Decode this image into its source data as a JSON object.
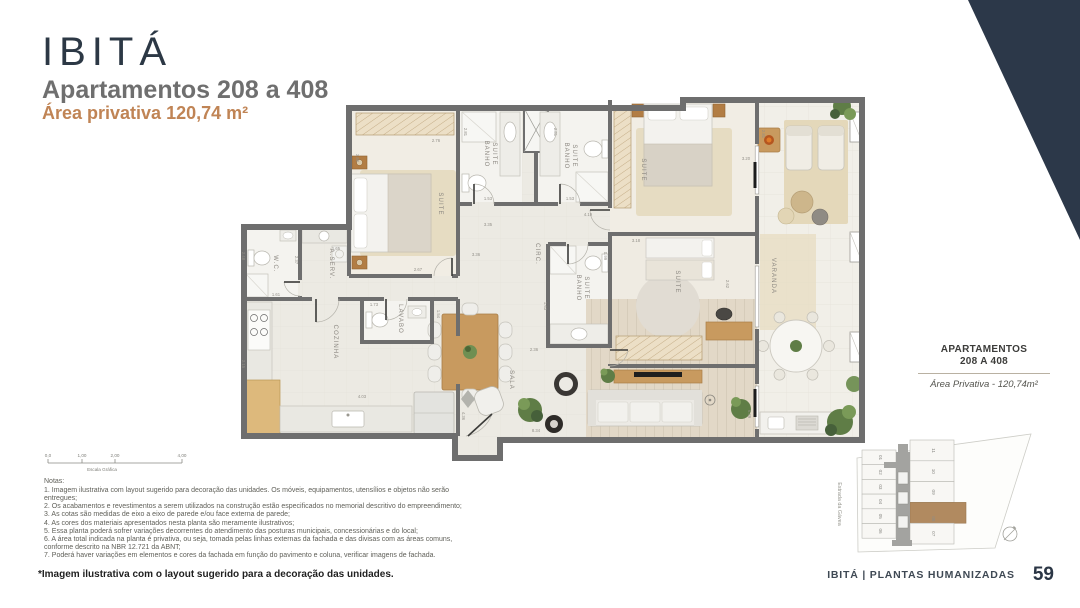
{
  "page": {
    "background": "#ffffff",
    "accent_color": "#2c3849"
  },
  "header": {
    "logo": "IBITÁ",
    "title": "Apartamentos 208 a 408",
    "subtitle": "Área privativa 120,74 m²"
  },
  "plan": {
    "room_labels": [
      {
        "t": "SUITE",
        "x": 203,
        "y": 120
      },
      {
        "t": "BANHO",
        "x": 249,
        "y": 70
      },
      {
        "t": "SUITE",
        "x": 257,
        "y": 70
      },
      {
        "t": "BANHO",
        "x": 329,
        "y": 72
      },
      {
        "t": "SUITE",
        "x": 337,
        "y": 72
      },
      {
        "t": "SUITE",
        "x": 406,
        "y": 86
      },
      {
        "t": "VARANDA",
        "x": 536,
        "y": 192
      },
      {
        "t": "CIRC.",
        "x": 300,
        "y": 170
      },
      {
        "t": "BANHO",
        "x": 341,
        "y": 204
      },
      {
        "t": "SUITE",
        "x": 349,
        "y": 204
      },
      {
        "t": "SUITE",
        "x": 440,
        "y": 198
      },
      {
        "t": "W.C.",
        "x": 38,
        "y": 180
      },
      {
        "t": "A.SERV.",
        "x": 94,
        "y": 180
      },
      {
        "t": "LAVABO",
        "x": 163,
        "y": 235
      },
      {
        "t": "COZINHA",
        "x": 98,
        "y": 258
      },
      {
        "t": "SALA",
        "x": 274,
        "y": 296
      }
    ],
    "dim_labels": [
      {
        "t": "3.80",
        "x": 120,
        "y": 74,
        "v": 1
      },
      {
        "t": "2.76",
        "x": 200,
        "y": 58,
        "v": 0
      },
      {
        "t": "2.81",
        "x": 228,
        "y": 48,
        "v": 1
      },
      {
        "t": "2.81",
        "x": 318,
        "y": 48,
        "v": 1
      },
      {
        "t": "2.81",
        "x": 526,
        "y": 50,
        "v": 1
      },
      {
        "t": "1.53",
        "x": 252,
        "y": 116,
        "v": 0
      },
      {
        "t": "1.53",
        "x": 334,
        "y": 116,
        "v": 0
      },
      {
        "t": "4.19",
        "x": 352,
        "y": 132,
        "v": 0
      },
      {
        "t": "3.35",
        "x": 252,
        "y": 142,
        "v": 0
      },
      {
        "t": "3.36",
        "x": 240,
        "y": 172,
        "v": 0
      },
      {
        "t": "2.67",
        "x": 182,
        "y": 187,
        "v": 0
      },
      {
        "t": "3.18",
        "x": 400,
        "y": 158,
        "v": 0
      },
      {
        "t": "3.20",
        "x": 510,
        "y": 76,
        "v": 0
      },
      {
        "t": "0.99",
        "x": 368,
        "y": 172,
        "v": 1
      },
      {
        "t": "2.62",
        "x": 490,
        "y": 200,
        "v": 1
      },
      {
        "t": "6.39",
        "x": 512,
        "y": 330,
        "v": 1
      },
      {
        "t": "2.48",
        "x": 6,
        "y": 172,
        "v": 1
      },
      {
        "t": "2.37",
        "x": 59,
        "y": 176,
        "v": 1
      },
      {
        "t": "1.65",
        "x": 100,
        "y": 166,
        "v": 0
      },
      {
        "t": "1.61",
        "x": 40,
        "y": 212,
        "v": 0
      },
      {
        "t": "1.73",
        "x": 138,
        "y": 222,
        "v": 0
      },
      {
        "t": "1.54",
        "x": 201,
        "y": 230,
        "v": 1
      },
      {
        "t": "4.03",
        "x": 126,
        "y": 314,
        "v": 0
      },
      {
        "t": "2.15",
        "x": 6,
        "y": 280,
        "v": 1
      },
      {
        "t": "2.36",
        "x": 298,
        "y": 267,
        "v": 0
      },
      {
        "t": "1.63",
        "x": 308,
        "y": 222,
        "v": 1
      },
      {
        "t": "4.36",
        "x": 226,
        "y": 332,
        "v": 1
      },
      {
        "t": "8.34",
        "x": 300,
        "y": 348,
        "v": 0
      }
    ]
  },
  "scale_bar": {
    "ticks": [
      "0,0",
      "1,00",
      "2,00",
      "4,00"
    ],
    "caption": "Escala Gráfica"
  },
  "notes": {
    "heading": "Notas:",
    "items": [
      "1. Imagem ilustrativa com layout sugerido para decoração das unidades. Os móveis, equipamentos, utensílios e objetos não serão entregues;",
      "2. Os acabamentos e revestimentos a serem utilizados na construção estão especificados no memorial descritivo do empreendimento;",
      "3. As cotas são medidas de eixo a eixo de parede e/ou face externa de parede;",
      "4. As cores dos materiais apresentados nesta planta são meramente ilustrativos;",
      "5. Essa planta poderá sofrer variações decorrentes do atendimento das posturas municipais, concessionárias e do local;",
      "6. A área total indicada na planta é privativa, ou seja, tomada pelas linhas externas da fachada e das divisas com as áreas comuns, conforme descrito na NBR 12.721 da ABNT;",
      "7. Poderá haver variações em elementos e cores da fachada em função do pavimento e coluna, verificar imagens de fachada."
    ]
  },
  "side_panel": {
    "title_line1": "APARTAMENTOS",
    "title_line2": "208 A 408",
    "area_label": "Área Privativa - 120,74m²"
  },
  "site_plan": {
    "street": "Estrada da Gávea",
    "units_left": [
      "01",
      "02",
      "03",
      "04",
      "05",
      "06"
    ],
    "units_right": [
      "11",
      "10",
      "09",
      "08",
      "07"
    ],
    "highlighted_unit": "08",
    "highlight_color": "#b18a60"
  },
  "footer": {
    "disclaimer": "*Imagem ilustrativa com o layout sugerido para a decoração das unidades.",
    "brand": "IBITÁ | PLANTAS HUMANIZADAS",
    "page_number": "59"
  }
}
